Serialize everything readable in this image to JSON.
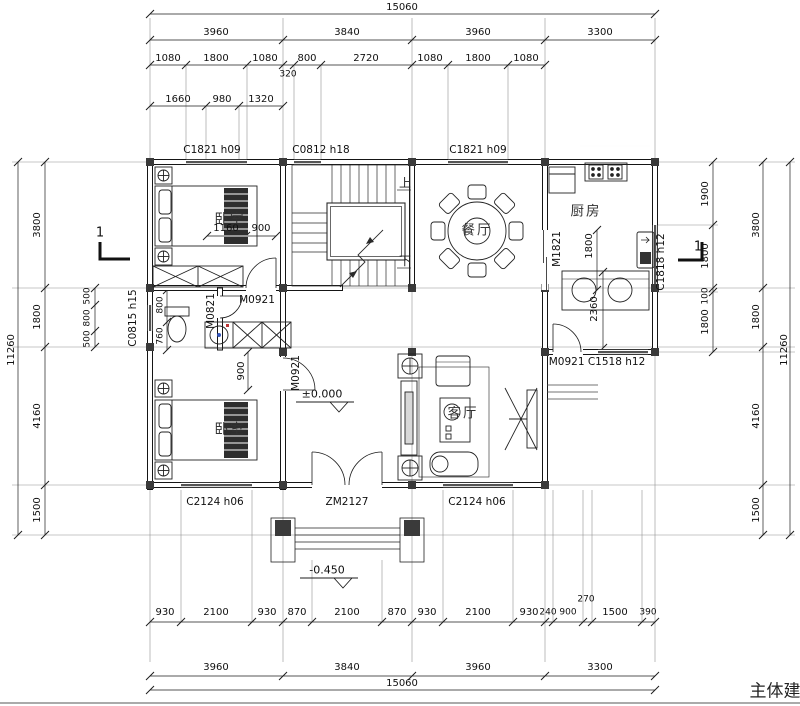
{
  "title_block": {
    "partial_text": "主体建"
  },
  "rooms": {
    "bedroom_upper": "卧室",
    "bedroom_lower": "卧室",
    "dining": "餐厅",
    "kitchen": "厨房",
    "living": "客厅"
  },
  "stairs": {
    "up": "上",
    "down": "下"
  },
  "levels": {
    "ground": "±0.000",
    "porch": "-0.450"
  },
  "section": {
    "mark": "1"
  },
  "openings": {
    "c1821a": "C1821 h09",
    "c0812": "C0812 h18",
    "c1821b": "C1821 h09",
    "m1821": "M1821",
    "c1818": "C1818 h12",
    "c0815": "C0815 h15",
    "m0821": "M0821",
    "m0921a": "M0921",
    "m0921b": "M0921",
    "m0921c": "M0921 C1518 h12",
    "c2124a": "C2124 h06",
    "zm2127": "ZM2127",
    "c2124b": "C2124 h06"
  },
  "dims": {
    "top": {
      "total": "15060",
      "bays": [
        "3960",
        "3840",
        "3960",
        "3300"
      ],
      "detail": [
        "1080",
        "1800",
        "1080",
        "320",
        "800",
        "2720",
        "1080",
        "1800",
        "1080"
      ],
      "sub": [
        "1660",
        "980",
        "1320"
      ]
    },
    "bottom": {
      "detail": [
        "930",
        "2100",
        "930",
        "870",
        "2100",
        "870",
        "930",
        "2100",
        "930",
        "240",
        "900",
        "270",
        "1500",
        "390"
      ],
      "bays": [
        "3960",
        "3840",
        "3960",
        "3300"
      ],
      "total": "15060"
    },
    "left": {
      "total": "11260",
      "chain": [
        "3800",
        "1800",
        "4160",
        "1500"
      ],
      "inner": [
        "500",
        "800",
        "500"
      ],
      "bath": [
        "800",
        "760"
      ]
    },
    "right": {
      "total": "11260",
      "chain": [
        "3800",
        "1800",
        "4160",
        "1500"
      ],
      "inner": [
        "1900",
        "1800",
        "100",
        "1800"
      ]
    },
    "interior": {
      "d1160": "1160",
      "d900a": "900",
      "d900b": "900",
      "k1800": "1800",
      "k2360": "2360"
    }
  }
}
